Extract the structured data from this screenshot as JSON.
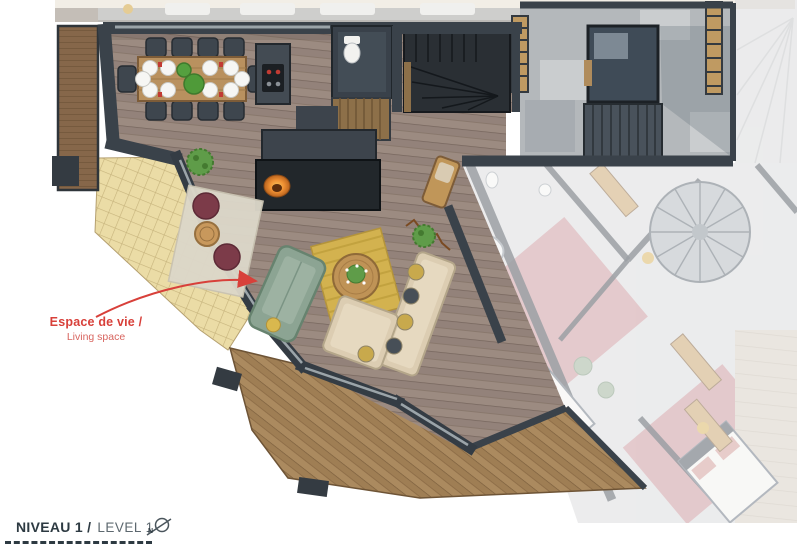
{
  "annotation": {
    "label_fr": "Espace de vie /",
    "label_en": "Living space",
    "color": "#d8403a"
  },
  "title_block": {
    "level_fr": "NIVEAU 1 /",
    "level_en": "LEVEL 1",
    "north_letter": "N"
  },
  "palette": {
    "annotation_red": "#d8403a",
    "ink_dark": "#2d3a42",
    "ink_muted": "#5d686f",
    "wall_dark": "#3a424a",
    "stair_dark": "#2a2f34",
    "wood_floor": "#9a897f",
    "deck_wood": "#ab8a5f",
    "terrace_stone": "#ebdca6",
    "balcony_wood": "#86674a",
    "hall_stone": "#b4b8bb",
    "sofa_green": "#8ca493",
    "rug_gold": "#d3b24f",
    "rug_light": "#dcd7c9",
    "pouf_plum": "#7c3b49",
    "sectional_beige": "#dccdb2",
    "fire_orange": "#ef9033",
    "faded_pink": "#c9959b"
  }
}
